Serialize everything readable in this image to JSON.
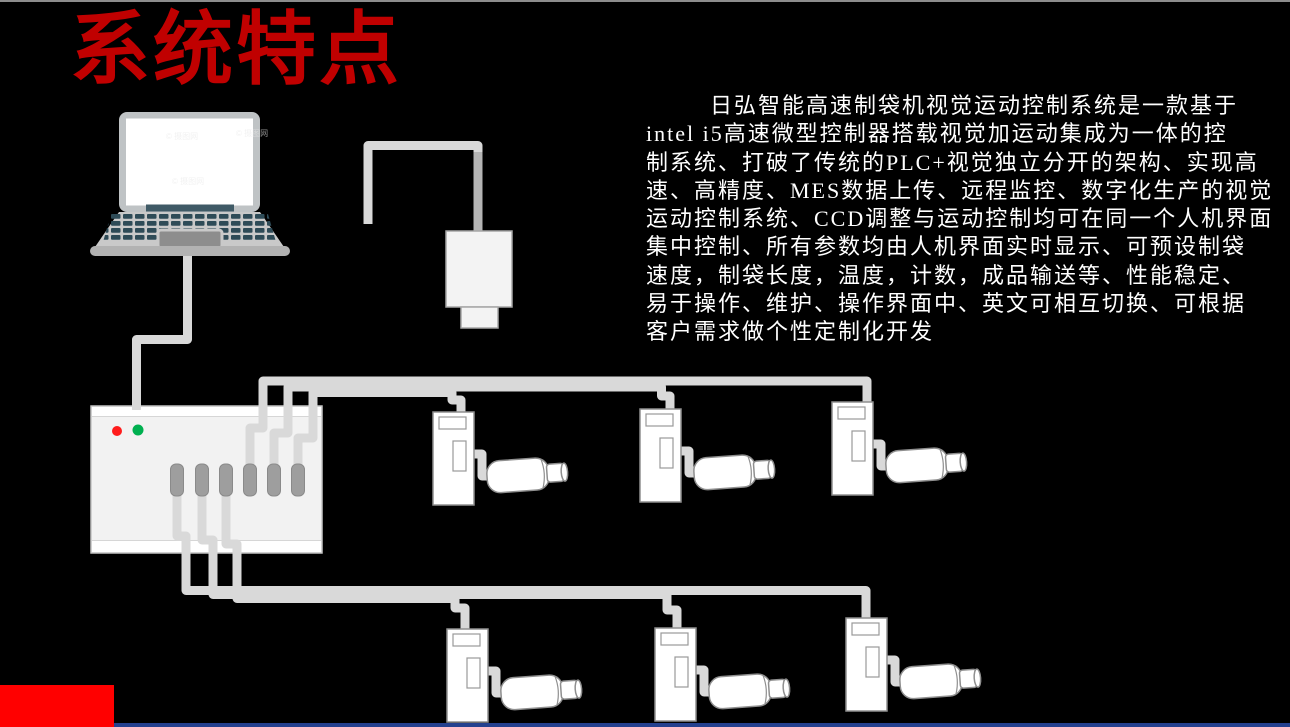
{
  "slide": {
    "title": "系统特点",
    "body_text": {
      "lines": [
        "日弘智能高速制袋机视觉运动控制系统是一款基于",
        "intel i5高速微型控制器搭载视觉加运动集成为一体的控",
        "制系统、打破了传统的PLC+视觉独立分开的架构、实现高",
        "速、高精度、MES数据上传、远程监控、数字化生产的视觉",
        "运动控制系统、CCD调整与运动控制均可在同一个人机界面",
        "集中控制、所有参数均由人机界面实时显示、可预设制袋",
        "速度，制袋长度，温度，计数，成品输送等、性能稳定、",
        "易于操作、维护、操作界面中、英文可相互切换、可根据",
        "客户需求做个性定制化开发"
      ]
    },
    "watermark": "© 摄图网"
  },
  "diagram": {
    "device_names": [
      "laptop",
      "ccd-camera",
      "motion-controller",
      "servo-driver-with-motor"
    ],
    "servo_unit_count": 6,
    "controller_port_count": 6,
    "controller_led_colors": {
      "power": "#ff1c1c",
      "run": "#00b050"
    }
  },
  "colors": {
    "background": "#000000",
    "title_red": "#c00000",
    "bottom_left_red": "#ff0000",
    "bottom_bar_blue": "#24408e",
    "top_edge_gray": "#8c8c8c",
    "cable_gray": "#d9d9d9",
    "device_fill": "#ffffff",
    "device_stroke": "#8f8f8f"
  }
}
